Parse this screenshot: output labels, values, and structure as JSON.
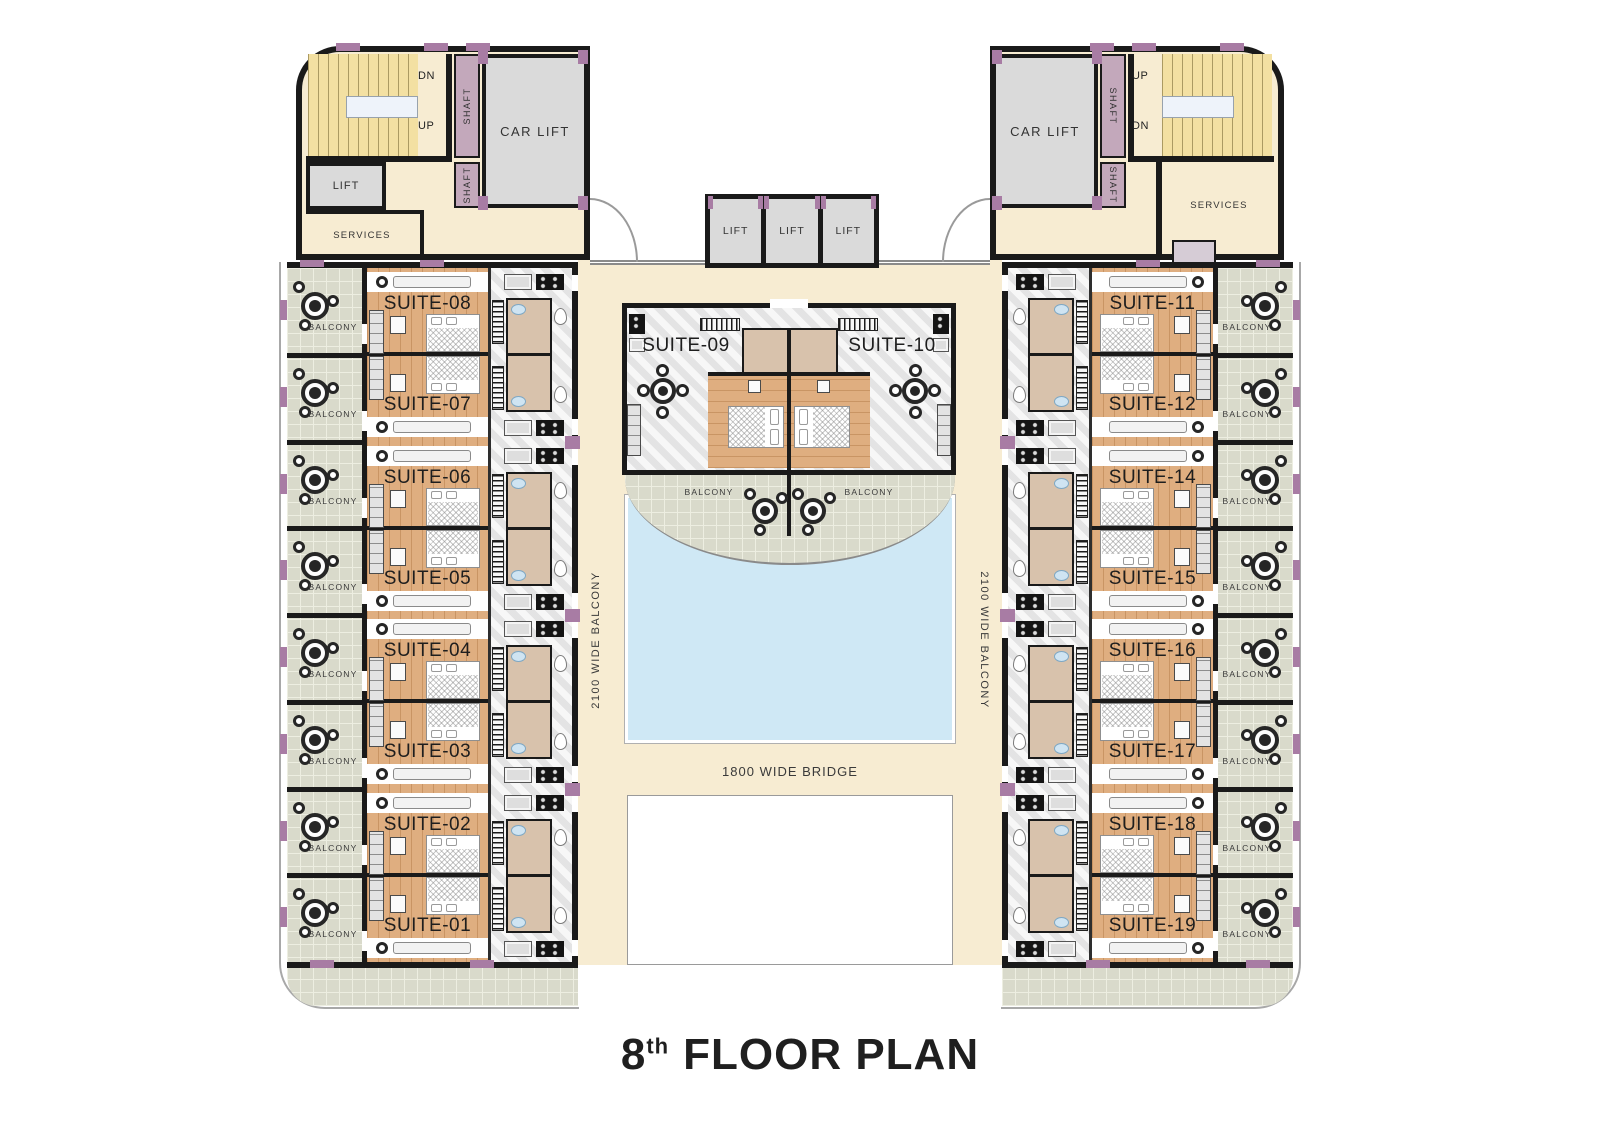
{
  "title": {
    "number": "8",
    "suffix": "th",
    "label": "FLOOR PLAN"
  },
  "corridors": {
    "left": "2100 WIDE BALCONY",
    "right": "2100 WIDE BALCONY",
    "bridge": "1800 WIDE BRIDGE"
  },
  "center_lifts": {
    "labels": [
      "LIFT",
      "LIFT",
      "LIFT"
    ]
  },
  "center_block": {
    "left_suite": "SUITE-09",
    "right_suite": "SUITE-10",
    "left_balcony": "BALCONY",
    "right_balcony": "BALCONY"
  },
  "top_left_block": {
    "dn": "DN",
    "up": "UP",
    "shaft_top": "SHAFT",
    "shaft_bottom": "SHAFT",
    "car_lift": "CAR LIFT",
    "lift": "LIFT",
    "services": "SERVICES"
  },
  "top_right_block": {
    "up": "UP",
    "dn": "DN",
    "shaft_top": "SHAFT",
    "shaft_bottom": "SHAFT",
    "car_lift": "CAR LIFT",
    "services": "SERVICES"
  },
  "left_wing": {
    "balcony_label": "BALCONY",
    "suite_pairs": [
      [
        "SUITE-08",
        "SUITE-07"
      ],
      [
        "SUITE-06",
        "SUITE-05"
      ],
      [
        "SUITE-04",
        "SUITE-03"
      ],
      [
        "SUITE-02",
        "SUITE-01"
      ]
    ]
  },
  "right_wing": {
    "balcony_label": "BALCONY",
    "suite_pairs": [
      [
        "SUITE-11",
        "SUITE-12"
      ],
      [
        "SUITE-14",
        "SUITE-15"
      ],
      [
        "SUITE-16",
        "SUITE-17"
      ],
      [
        "SUITE-18",
        "SUITE-19"
      ]
    ]
  },
  "colors": {
    "wall": "#1a1a1a",
    "cream": "#f7ecd2",
    "tile": "#d9dacb",
    "wood": "#dfae80",
    "marble": "#ececec",
    "pool": "#cfe8f5",
    "stairs": "#f3e0a2",
    "shaft": "#c3a8bb",
    "door_accent": "#a87ca4",
    "bath": "#d8c2ac"
  }
}
